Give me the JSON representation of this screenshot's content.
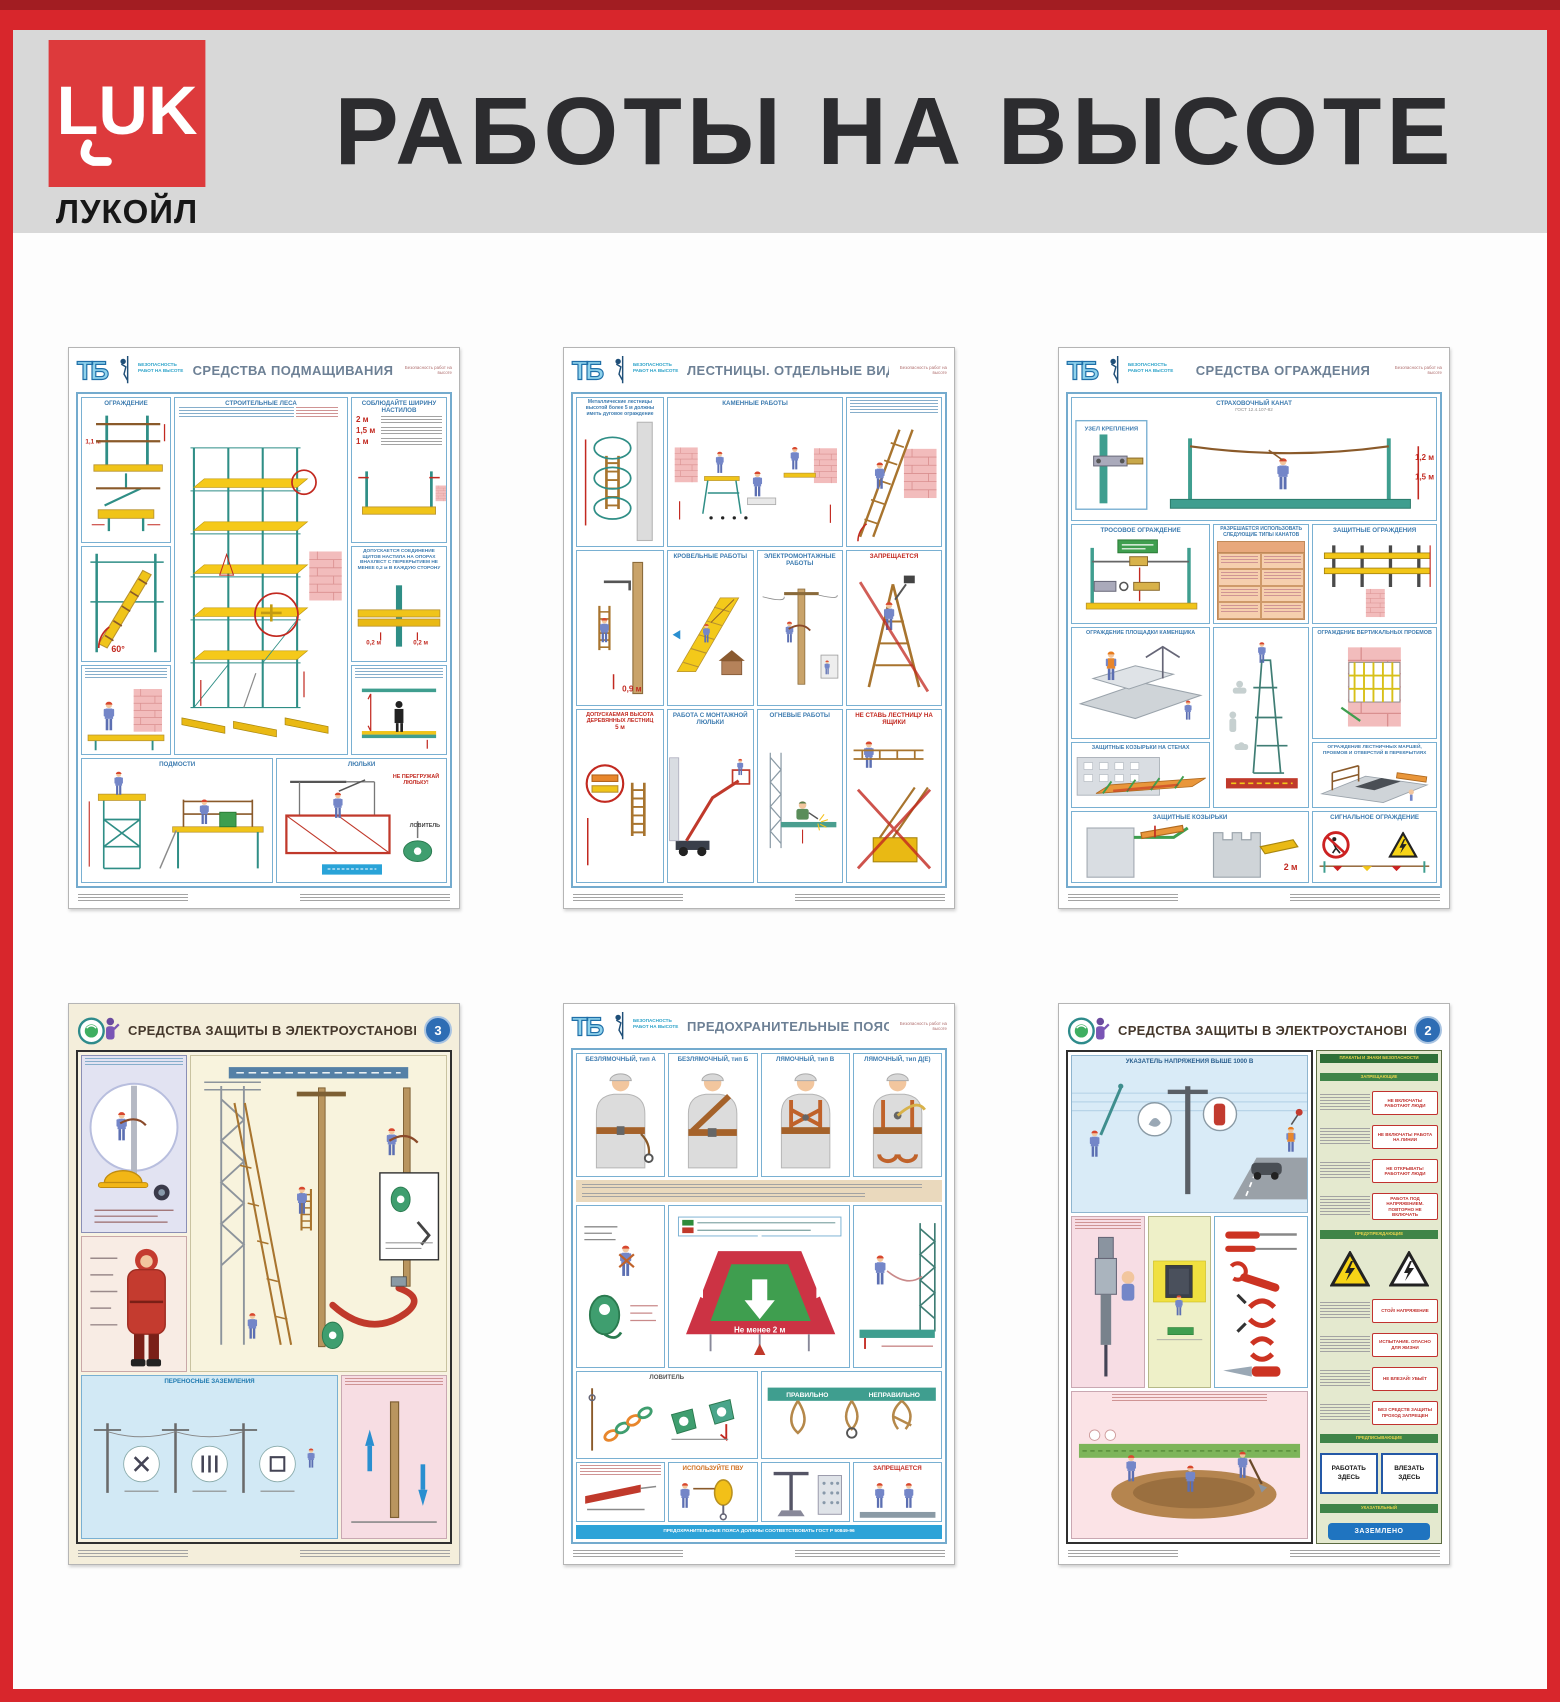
{
  "header": {
    "title": "РАБОТЫ НА ВЫСОТЕ",
    "company": "ЛУКОЙЛ",
    "logo_mark": "LUK"
  },
  "series": {
    "abbr": "ТБ",
    "note": "БЕЗОПАСНОСТЬ РАБОТ НА ВЫСОТЕ",
    "corner": "Безопасность работ на высоте"
  },
  "colors": {
    "frame_red": "#d8262c",
    "panel_blue": "#74abce",
    "accent_red": "#c22920",
    "deck_yellow": "#f0c419"
  },
  "posters": {
    "p1": {
      "title": "СРЕДСТВА ПОДМАЩИВАНИЯ",
      "pan": {
        "ogr": "ОГРАЖДЕНИЕ",
        "h11": "1,1 м",
        "lesa": "СТРОИТЕЛЬНЫЕ ЛЕСА",
        "shir": "СОБЛЮДАЙТЕ ШИРИНУ НАСТИЛОВ",
        "w1": "2 м",
        "w2": "1,5 м",
        "w3": "1 м",
        "angle": "60°",
        "note02": "ДОПУСКАЕТСЯ СОЕДИНЕНИЕ ЩИТОВ НАСТИЛА НА ОПОРАХ ВНАХЛЕСТ С ПЕРЕКРЫТИЕМ НЕ МЕНЕЕ 0,2 м В КАЖДУЮ СТОРОНУ",
        "d02": "0,2 м",
        "podmosti": "ПОДМОСТИ",
        "lyulki": "ЛЮЛЬКИ",
        "warn": "НЕ ПЕРЕГРУЖАЙ ЛЮЛЬКУ!",
        "lovitel": "ЛОВИТЕЛЬ"
      }
    },
    "p2": {
      "title": "ЛЕСТНИЦЫ. ОТДЕЛЬНЫЕ ВИДЫ РАБОТ",
      "pan": {
        "note": "Металлические лестницы высотой более 5 м должны иметь дуговое ограждение",
        "kam": "КАМЕННЫЕ РАБОТЫ",
        "krov": "КРОВЕЛЬНЫЕ РАБОТЫ",
        "elek": "ЭЛЕКТРОМОНТАЖНЫЕ РАБОТЫ",
        "dv": "ДОПУСКАЕМАЯ ВЫСОТА ДЕРЕВЯННЫХ ЛЕСТНИЦ",
        "dv2": "5 м",
        "lm": "РАБОТА С МОНТАЖНОЙ ЛЮЛЬКИ",
        "ogn": "ОГНЕВЫЕ РАБОТЫ",
        "zapr": "ЗАПРЕЩАЕТСЯ",
        "nestav": "НЕ СТАВЬ ЛЕСТНИЦУ НА ЯЩИКИ",
        "a75": "до 75°",
        "h09": "0,9 м"
      }
    },
    "p3": {
      "title": "СРЕДСТВА ОГРАЖДЕНИЯ",
      "pan": {
        "kanat": "СТРАХОВОЧНЫЙ КАНАТ",
        "gost": "ГОСТ 12.4.107-82",
        "uzel": "УЗЕЛ КРЕПЛЕНИЯ",
        "h12": "1,2 м",
        "h15": "1,5 м",
        "tros": "ТРОСОВОЕ ОГРАЖДЕНИЕ",
        "table": "РАЗРЕШАЕТСЯ ИСПОЛЬЗОВАТЬ СЛЕДУЮЩИЕ ТИПЫ КАНАТОВ",
        "zashch": "ЗАЩИТНЫЕ ОГРАЖДЕНИЯ",
        "plo": "ОГРАЖДЕНИЕ ПЛОЩАДКИ КАМЕНЩИКА",
        "vert": "ОГРАЖДЕНИЕ ВЕРТИКАЛЬНЫХ ПРОЕМОВ",
        "koz1": "ЗАЩИТНЫЕ КОЗЫРЬКИ НА СТЕНАХ",
        "marshi": "ОГРАЖДЕНИЕ ЛЕСТНИЧНЫХ МАРШЕЙ, ПРОЕМОВ И ОТВЕРСТИЙ В ПЕРЕКРЫТИЯХ",
        "koz2": "ЗАЩИТНЫЕ КОЗЫРЬКИ",
        "sig": "СИГНАЛЬНОЕ ОГРАЖДЕНИЕ",
        "h2": "2 м"
      }
    },
    "p4": {
      "title": "СРЕДСТВА ЗАЩИТЫ В ЭЛЕКТРОУСТАНОВКАХ",
      "badge": "3",
      "pan": {
        "zaz": "ПЕРЕНОСНЫЕ ЗАЗЕМЛЕНИЯ"
      }
    },
    "p5": {
      "title": "ПРЕДОХРАНИТЕЛЬНЫЕ ПОЯСА",
      "belts": {
        "b1": "БЕЗЛЯМОЧНЫЙ, тип А",
        "b2": "БЕЗЛЯМОЧНЫЙ, тип Б",
        "b3": "ЛЯМОЧНЫЙ, тип В",
        "b4": "ЛЯМОЧНЫЙ, тип Д(Е)"
      },
      "pan": {
        "plat": "Не менее 2 м",
        "lov": "ЛОВИТЕЛЬ",
        "pvu": "ИСПОЛЬЗУЙТЕ ПВУ",
        "zapr": "ЗАПРЕЩАЕТСЯ",
        "prav": "ПРАВИЛЬНО",
        "neprav": "НЕПРАВИЛЬНО",
        "footer": "ПРЕДОХРАНИТЕЛЬНЫЕ ПОЯСА ДОЛЖНЫ СООТВЕТСТВОВАТЬ ГОСТ Р 50849-96"
      }
    },
    "p6": {
      "title": "СРЕДСТВА ЗАЩИТЫ В ЭЛЕКТРОУСТАНОВКАХ",
      "badge": "2",
      "pan": {
        "ukaz": "УКАЗАТЕЛЬ НАПРЯЖЕНИЯ ВЫШЕ 1000 В",
        "header": "ПЛАКАТЫ И ЗНАКИ БЕЗОПАСНОСТИ",
        "g1": "ЗАПРЕЩАЮЩИЕ",
        "g2": "ПРЕДУПРЕЖДАЮЩИЕ",
        "g3": "ПРЕДПИСЫВАЮЩИЕ",
        "g4": "УКАЗАТЕЛЬНЫЙ",
        "s1": "НЕ ВКЛЮЧАТЬ! РАБОТАЮТ ЛЮДИ",
        "s2": "НЕ ВКЛЮЧАТЬ! РАБОТА НА ЛИНИИ",
        "s3": "НЕ ОТКРЫВАТЬ! РАБОТАЮТ ЛЮДИ",
        "s4": "РАБОТА ПОД НАПРЯЖЕНИЕМ. ПОВТОРНО НЕ ВКЛЮЧАТЬ",
        "t1": "СТОЙ! НАПРЯЖЕНИЕ",
        "t2": "ИСПЫТАНИЕ. ОПАСНО ДЛЯ ЖИЗНИ",
        "t3": "НЕ ВЛЕЗАЙ! УБЬЁТ",
        "t4": "БЕЗ СРЕДСТВ ЗАЩИТЫ ПРОХОД ЗАПРЕЩЕН",
        "rab": "РАБОТАТЬ ЗДЕСЬ",
        "vle": "ВЛЕЗАТЬ ЗДЕСЬ",
        "zaz": "ЗАЗЕМЛЕНО"
      }
    }
  }
}
